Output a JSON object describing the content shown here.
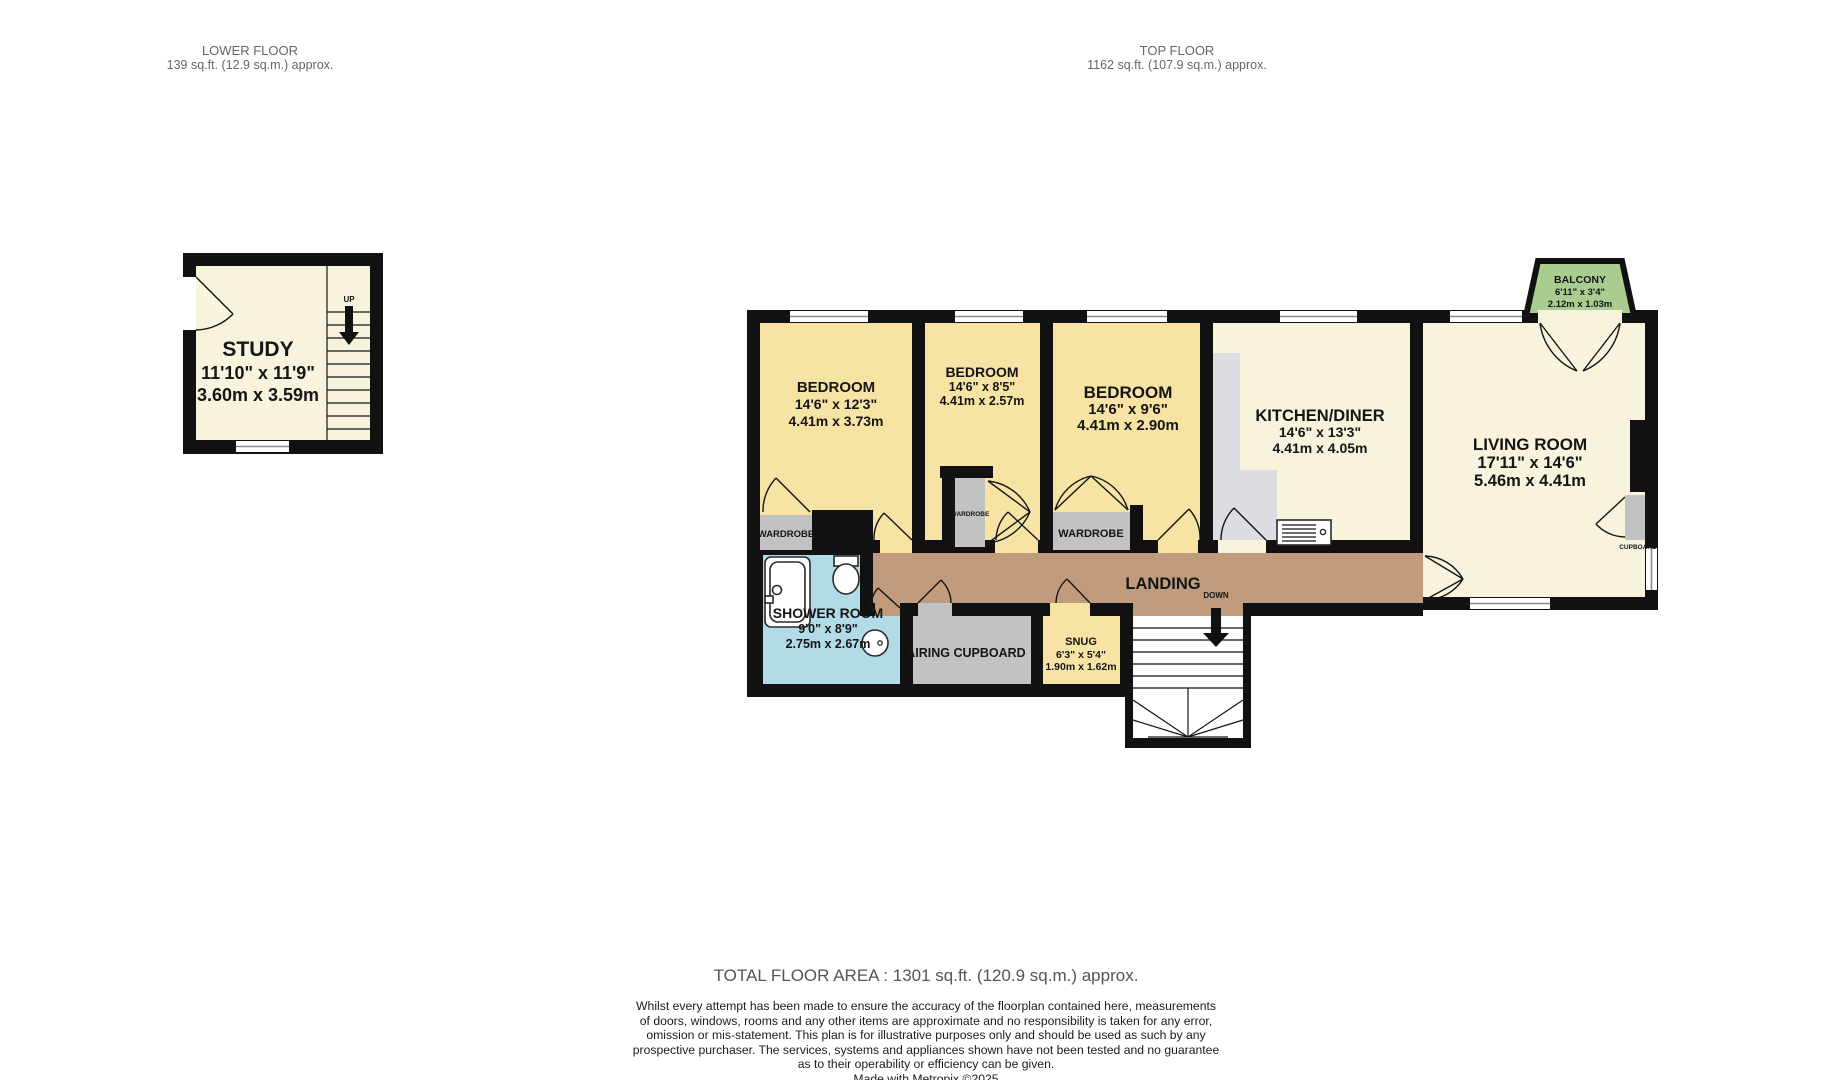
{
  "header": {
    "lower_floor": {
      "title": "LOWER FLOOR",
      "area": "139 sq.ft. (12.9 sq.m.) approx."
    },
    "top_floor": {
      "title": "TOP FLOOR",
      "area": "1162 sq.ft. (107.9 sq.m.) approx."
    }
  },
  "lower_floor_plan": {
    "study": {
      "name": "STUDY",
      "dims_imperial": "11'10\" x 11'9\"",
      "dims_metric": "3.60m x 3.59m"
    },
    "stairs_up_label": "UP"
  },
  "top_floor_plan": {
    "bedroom1": {
      "name": "BEDROOM",
      "dims_imperial": "14'6\" x 12'3\"",
      "dims_metric": "4.41m x 3.73m"
    },
    "bedroom2": {
      "name": "BEDROOM",
      "dims_imperial": "14'6\" x 8'5\"",
      "dims_metric": "4.41m x 2.57m"
    },
    "bedroom3": {
      "name": "BEDROOM",
      "dims_imperial": "14'6\" x 9'6\"",
      "dims_metric": "4.41m x 2.90m"
    },
    "kitchen": {
      "name": "KITCHEN/DINER",
      "dims_imperial": "14'6\" x 13'3\"",
      "dims_metric": "4.41m x 4.05m"
    },
    "living": {
      "name": "LIVING ROOM",
      "dims_imperial": "17'11\" x 14'6\"",
      "dims_metric": "5.46m x 4.41m"
    },
    "shower": {
      "name": "SHOWER ROOM",
      "dims_imperial": "9'0\" x 8'9\"",
      "dims_metric": "2.75m x 2.67m"
    },
    "snug": {
      "name": "SNUG",
      "dims_imperial": "6'3\" x 5'4\"",
      "dims_metric": "1.90m x 1.62m"
    },
    "balcony": {
      "name": "BALCONY",
      "dims_imperial": "6'11\" x 3'4\"",
      "dims_metric": "2.12m x 1.03m"
    },
    "landing": {
      "name": "LANDING"
    },
    "labels": {
      "down": "DOWN",
      "wardrobe": "WARDROBE",
      "airing_cupboard": "AIRING CUPBOARD",
      "cupboard": "CUPBOARD"
    }
  },
  "footer": {
    "total": "TOTAL FLOOR AREA : 1301 sq.ft. (120.9 sq.m.) approx.",
    "disclaimer_lines": [
      "Whilst every attempt has been made to ensure the accuracy of the floorplan contained here, measurements",
      "of doors, windows, rooms and any other items are approximate and no responsibility is taken for any error,",
      "omission or mis-statement. This plan is for illustrative purposes only and should be used as such by any",
      "prospective purchaser. The services, systems and appliances shown have not been tested and no guarantee",
      "as to their operability or efficiency can be given."
    ],
    "credit": "Made with Metropix ©2025"
  },
  "colors": {
    "wall": "#111111",
    "bedroom_yellow": "#F7E4A4",
    "cream": "#F8F3DC",
    "landing_tan": "#C09B7C",
    "shower_blue": "#B3DBE7",
    "unit_gray": "#C2C2C2",
    "counter_gray": "#DCDCE3",
    "balcony_green": "#A9CD90"
  }
}
